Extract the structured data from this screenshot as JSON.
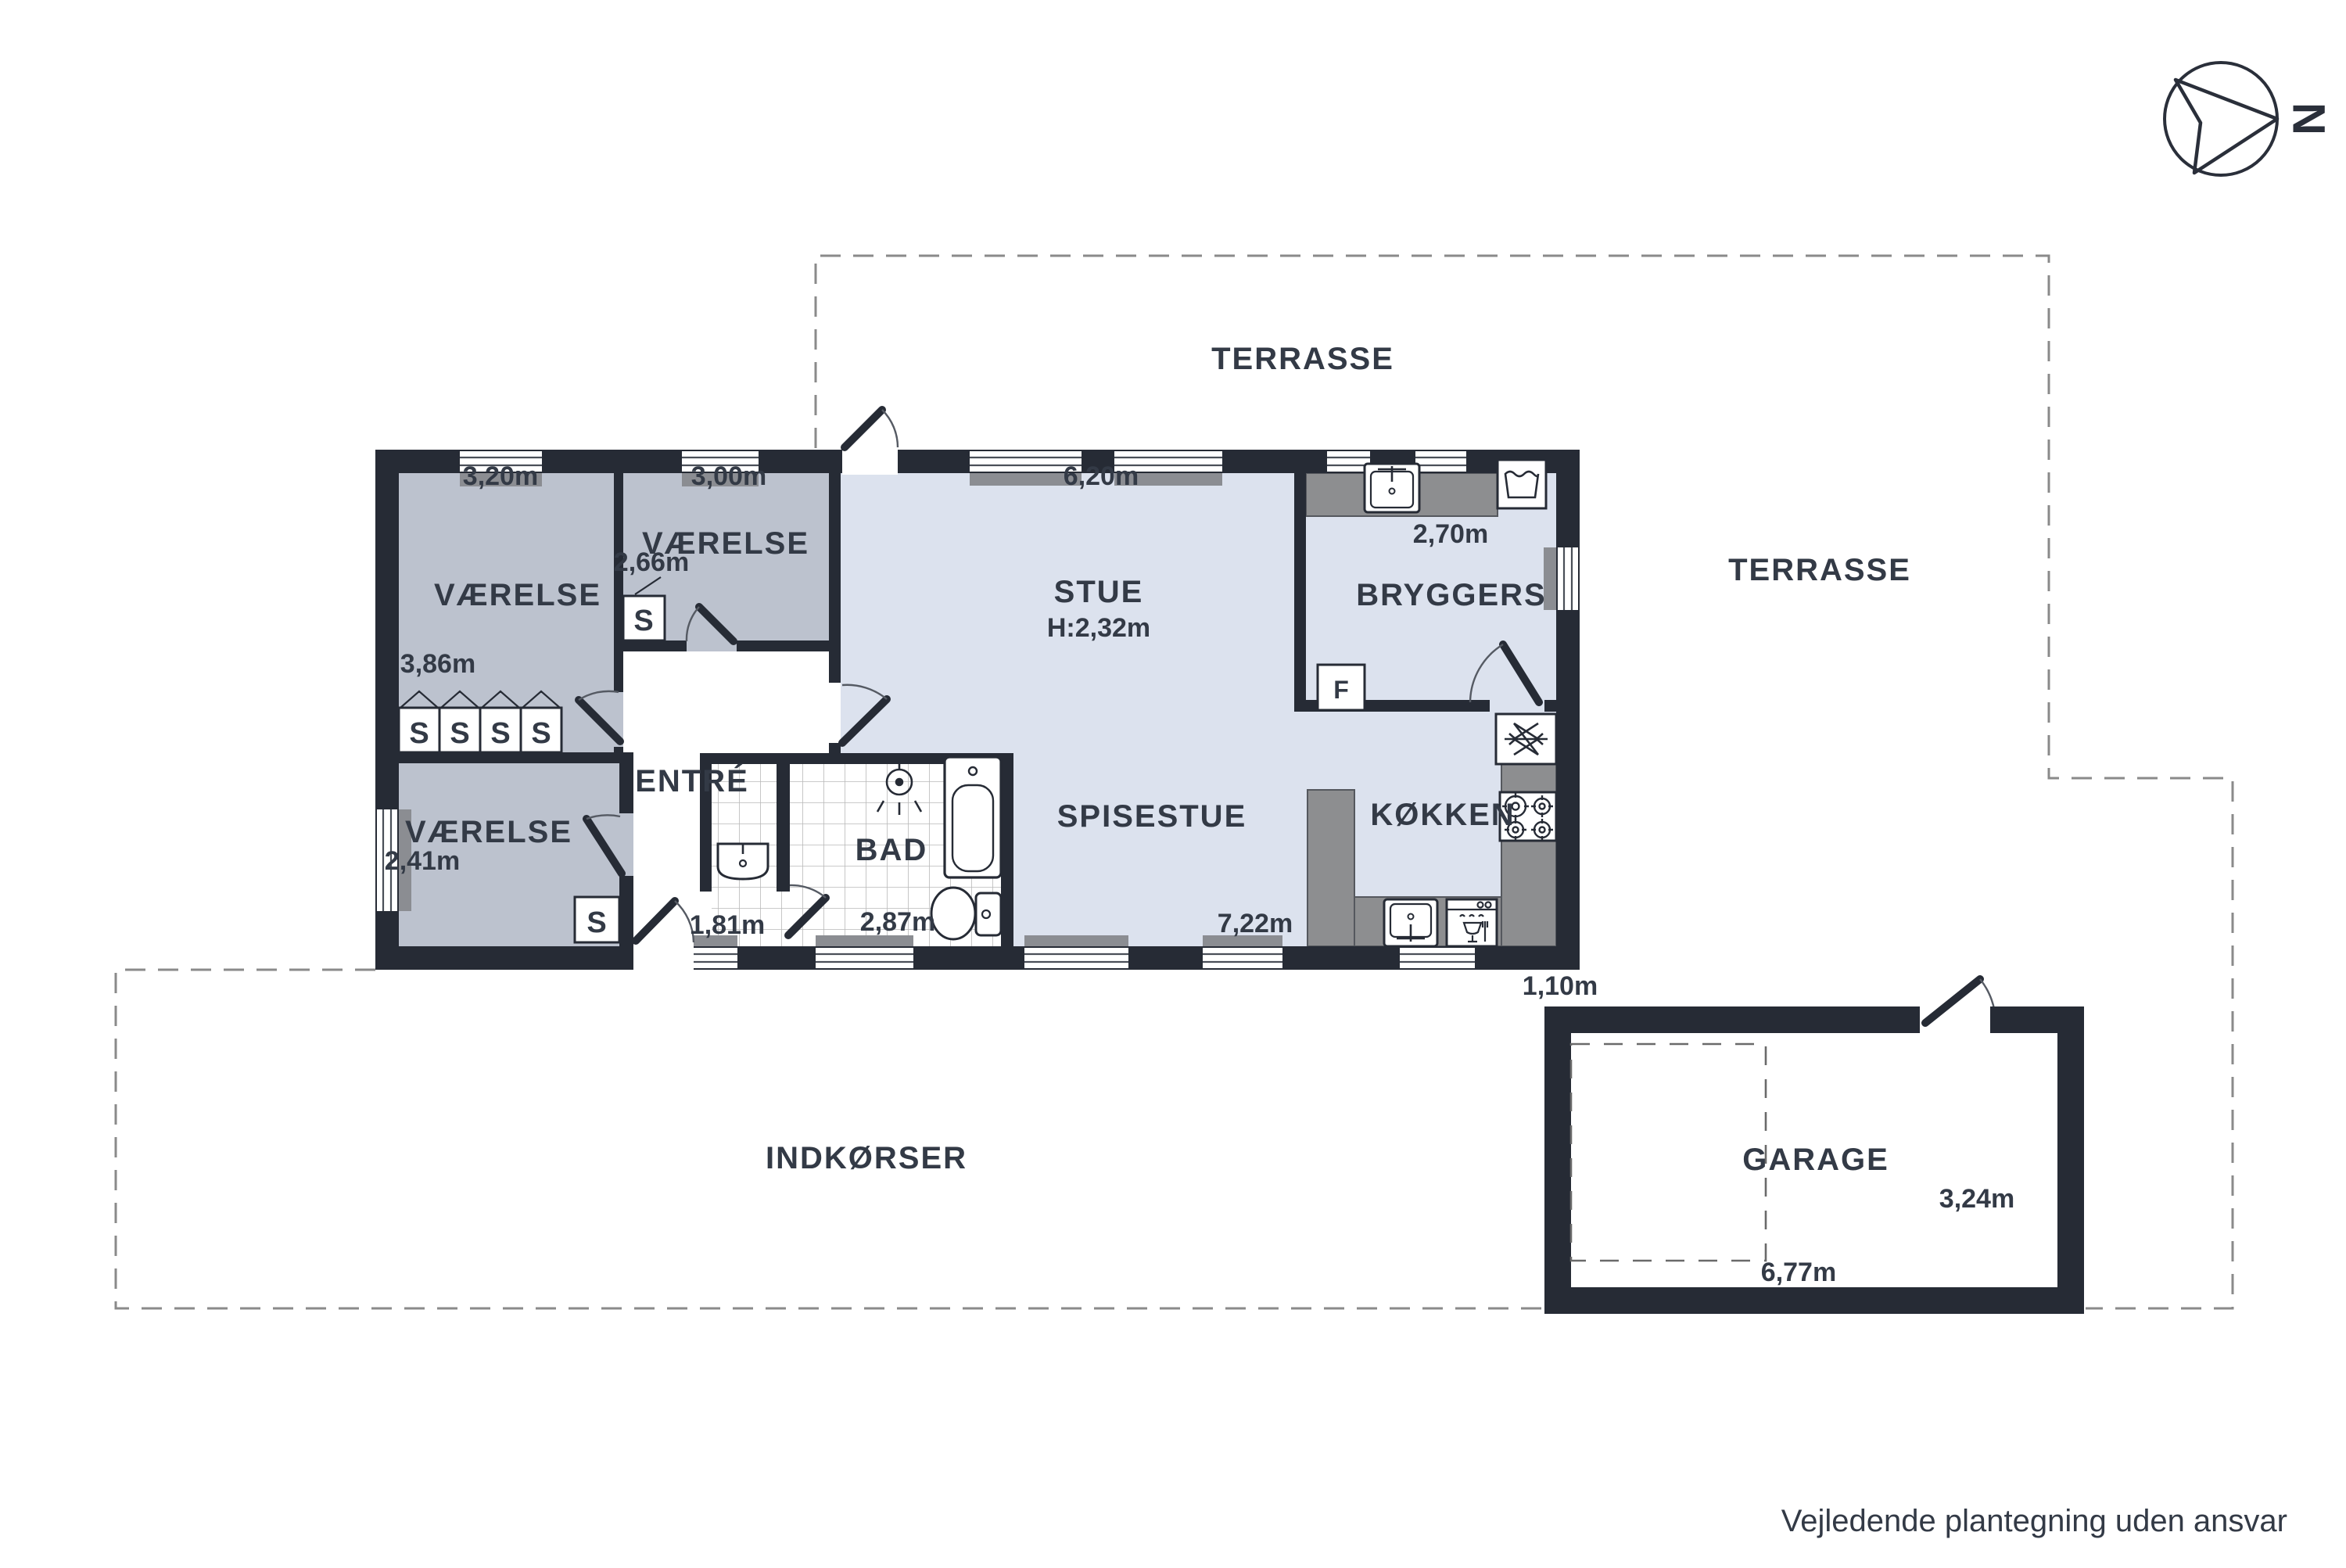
{
  "disclaimer": "Vejledende plantegning uden ansvar",
  "compass": {
    "north_letter": "N"
  },
  "outdoor": {
    "terrace_top_label": "TERRASSE",
    "terrace_right_label": "TERRASSE",
    "driveway_label": "INDKØRSER"
  },
  "garage": {
    "label": "GARAGE",
    "width_label": "6,77m",
    "depth_label": "3,24m",
    "gap_label": "1,10m"
  },
  "rooms": {
    "bedroom_nw": {
      "label": "VÆRELSE",
      "width_label": "3,20m",
      "depth_label": "3,86m"
    },
    "bedroom_n": {
      "label": "VÆRELSE",
      "width_label": "3,00m",
      "closet_label": "2,66m"
    },
    "bedroom_sw": {
      "label": "VÆRELSE",
      "width_label": "2,41m"
    },
    "living": {
      "label": "STUE",
      "ceiling_label": "H:2,32m",
      "width_label": "6,20m"
    },
    "dining": {
      "label": "SPISESTUE",
      "width_label": "7,22m"
    },
    "kitchen": {
      "label": "KØKKEN"
    },
    "utility": {
      "label": "BRYGGERS",
      "width_label": "2,70m"
    },
    "bath": {
      "label": "BAD",
      "width_label": "2,87m"
    },
    "entry": {
      "label": "ENTRÉ",
      "width_label": "1,81m"
    }
  },
  "symbols": {
    "closet": "S",
    "freezer": "F"
  },
  "colors": {
    "wall": "#262b35",
    "bedroom_fill": "#bcc2ce",
    "living_fill": "#dce2ee",
    "counter": "#8d8e90",
    "sill": "#8b8d92",
    "dash": "#8a8a8a",
    "text": "#333a46"
  }
}
